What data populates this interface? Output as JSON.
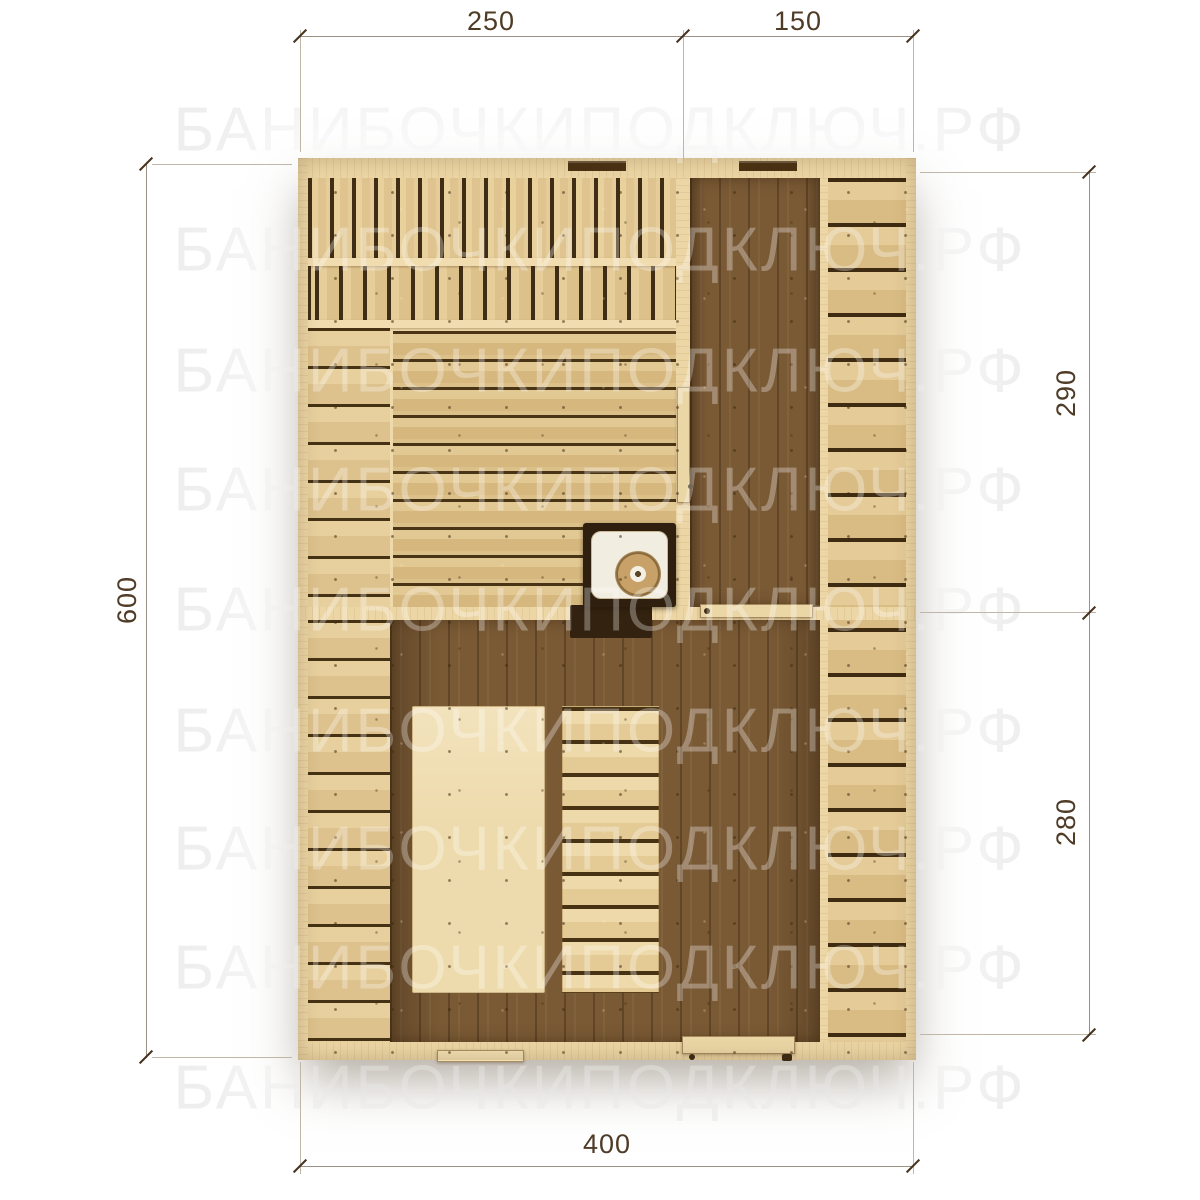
{
  "watermark": {
    "text": "БАНИБОЧКИПОДКЛЮЧ.РФ"
  },
  "dimensions": {
    "top_left": "250",
    "top_right": "150",
    "left": "600",
    "right_top": "290",
    "right_bottom": "280",
    "bottom": "400"
  },
  "colors": {
    "background": "#ffffff",
    "watermark": "#e7e7e7",
    "wood_light": "#e8d2a0",
    "wood_mid": "#d8bb84",
    "wood_gap": "#3f2d15",
    "wood_dark_floor": "#7a5a35",
    "stove_body": "#2e1f0e",
    "dimension_line": "#9a9083",
    "dimension_text": "#4f3b26"
  }
}
